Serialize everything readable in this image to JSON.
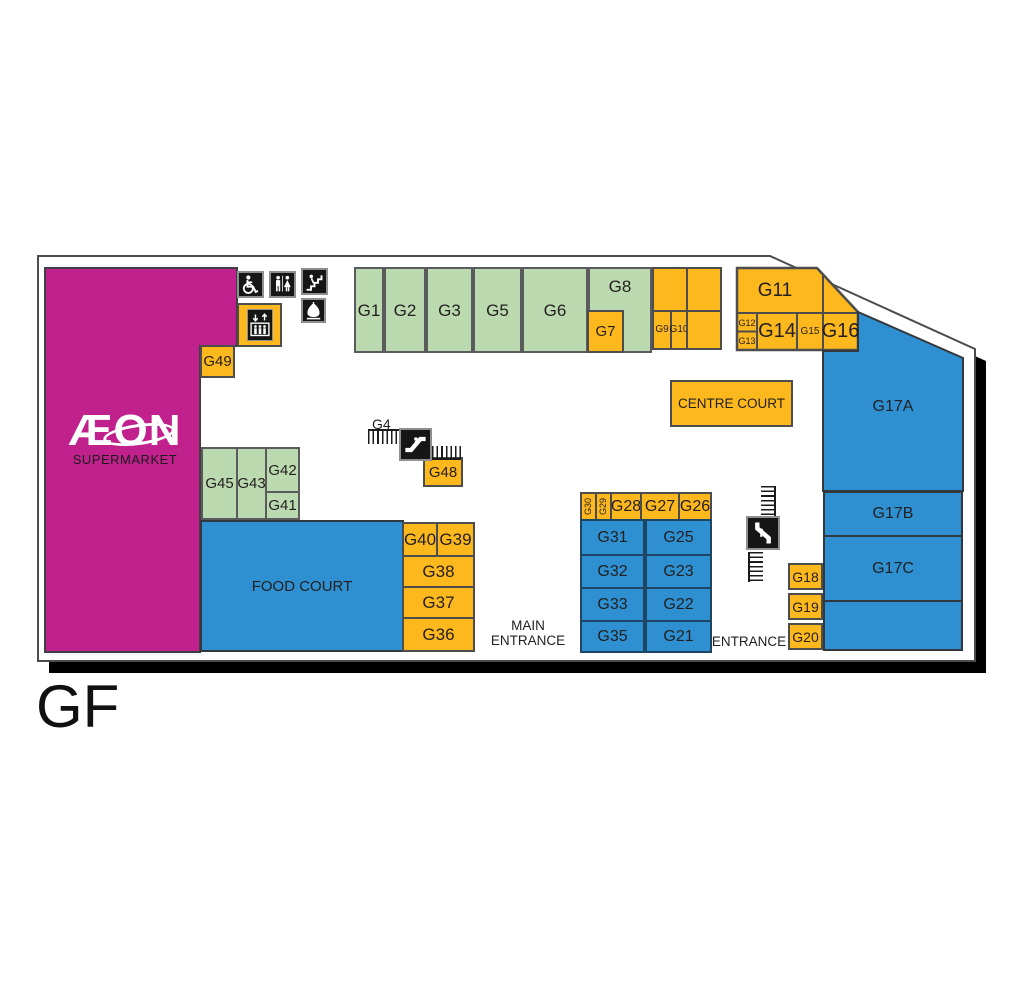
{
  "floor_label": "GF",
  "supermarket": {
    "brand": "ÆON",
    "subtitle": "SUPERMARKET"
  },
  "courts": {
    "centre": "CENTRE COURT",
    "food": "FOOD COURT"
  },
  "entrances": {
    "main_line1": "MAIN",
    "main_line2": "ENTRANCE",
    "side": "ENTRANCE"
  },
  "escalators": {
    "g4_label": "G4"
  },
  "rooms": {
    "g1": "G1",
    "g2": "G2",
    "g3": "G3",
    "g5": "G5",
    "g6": "G6",
    "g7": "G7",
    "g8": "G8",
    "g9": "G9",
    "g10": "G10",
    "g11": "G11",
    "g12": "G12",
    "g13": "G13",
    "g14": "G14",
    "g15": "G15",
    "g16": "G16",
    "g17a": "G17A",
    "g17b": "G17B",
    "g17c": "G17C",
    "g18": "G18",
    "g19": "G19",
    "g20": "G20",
    "g21": "G21",
    "g22": "G22",
    "g23": "G23",
    "g25": "G25",
    "g26": "G26",
    "g27": "G27",
    "g28": "G28",
    "g29": "G29",
    "g30": "G30",
    "g31": "G31",
    "g32": "G32",
    "g33": "G33",
    "g35": "G35",
    "g36": "G36",
    "g37": "G37",
    "g38": "G38",
    "g39": "G39",
    "g40": "G40",
    "g41": "G41",
    "g42": "G42",
    "g43": "G43",
    "g45": "G45",
    "g48": "G48",
    "g49": "G49"
  },
  "icons": {
    "wheelchair": "wheelchair-accessible",
    "toilets": "toilets",
    "stairs": "stairs",
    "prayer_room": "prayer-room",
    "elevator": "elevator",
    "escalator": "escalator",
    "travelator": "travelator"
  },
  "colors": {
    "magenta": "#C0218C",
    "yellow": "#FDB81E",
    "green": "#BCDAAF",
    "blue": "#2E90D0",
    "outline": "#4a4b4d",
    "shadow": "#000000",
    "text": "#231F20"
  }
}
